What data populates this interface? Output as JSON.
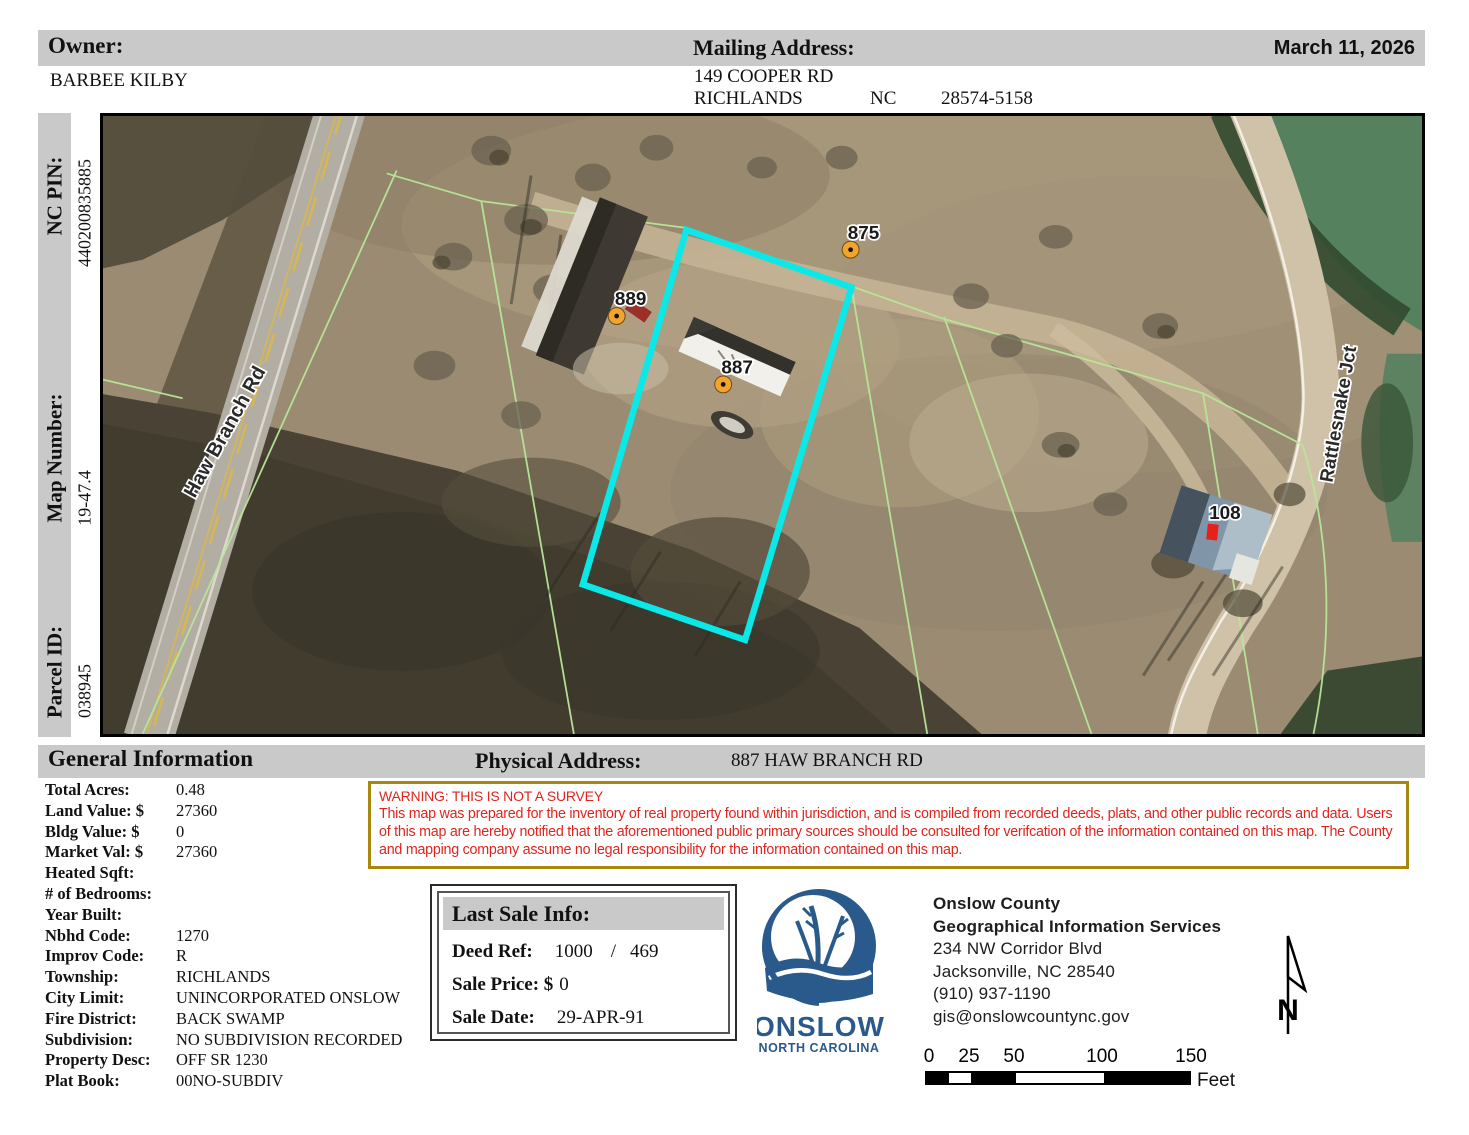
{
  "header": {
    "owner_label": "Owner:",
    "owner_value": "BARBEE KILBY",
    "mailing_label": "Mailing Address:",
    "mailing_line1": "149 COOPER RD",
    "mailing_city": "RICHLANDS",
    "mailing_state": "NC",
    "mailing_zip": "28574-5158",
    "date": "March 11, 2026"
  },
  "sidebar": {
    "nc_pin_label": "NC PIN:",
    "nc_pin_value": "440200835885",
    "map_number_label": "Map Number:",
    "map_number_value": "19-47.4",
    "parcel_id_label": "Parcel ID:",
    "parcel_id_value": "038945"
  },
  "map": {
    "road_label_left": "Haw Branch Rd",
    "road_label_right": "Rattlesnake Jct",
    "address_points": [
      {
        "id": "875"
      },
      {
        "id": "889"
      },
      {
        "id": "887"
      },
      {
        "id": "108"
      }
    ],
    "selected_parcel_color": "#0ae8e8",
    "address_marker_color": "#f2a52e",
    "house_marker_color": "#e8201c",
    "parcel_line_color": "#b8e698"
  },
  "general_info": {
    "section_title": "General Information",
    "physical_address_label": "Physical Address:",
    "physical_address_value": "887 HAW BRANCH RD",
    "fields": [
      {
        "label": "Total Acres:",
        "value": "0.48"
      },
      {
        "label": "Land Value: $",
        "value": "27360"
      },
      {
        "label": "Bldg Value: $",
        "value": "0"
      },
      {
        "label": "Market Val: $",
        "value": "27360"
      },
      {
        "label": "Heated Sqft:",
        "value": ""
      },
      {
        "label": "# of Bedrooms:",
        "value": ""
      },
      {
        "label": "Year Built:",
        "value": ""
      },
      {
        "label": "Nbhd Code:",
        "value": "1270"
      },
      {
        "label": "Improv Code:",
        "value": "R"
      },
      {
        "label": "Township:",
        "value": "RICHLANDS"
      },
      {
        "label": "City Limit:",
        "value": "UNINCORPORATED ONSLOW"
      },
      {
        "label": "Fire District:",
        "value": "BACK SWAMP"
      },
      {
        "label": "Subdivision:",
        "value": "NO SUBDIVISION RECORDED"
      },
      {
        "label": "Property Desc:",
        "value": "OFF SR 1230"
      },
      {
        "label": "Plat Book:",
        "value": "00NO-SUBDIV"
      }
    ]
  },
  "warning": {
    "title": "WARNING: THIS IS NOT A SURVEY",
    "body": "This map was prepared for the inventory of real property found within jurisdiction, and is compiled from recorded deeds, plats, and other public records and data. Users of this map are hereby notified that the aforementioned public primary sources should be consulted for verifcation of the information contained on this map. The County and mapping company assume no legal responsibility for the information contained on this map."
  },
  "last_sale": {
    "title": "Last Sale Info:",
    "deed_ref_label": "Deed Ref:",
    "deed_ref_book": "1000",
    "deed_ref_sep": "/",
    "deed_ref_page": "469",
    "sale_price_label": "Sale Price: $",
    "sale_price_value": "0",
    "sale_date_label": "Sale Date:",
    "sale_date_value": "29-APR-91"
  },
  "agency": {
    "logo_text": "ONSLOW",
    "logo_subtext": "NORTH CAROLINA",
    "logo_color": "#2a5a8c",
    "name": "Onslow County",
    "dept": "Geographical Information Services",
    "street": "234 NW Corridor Blvd",
    "city": "Jacksonville, NC 28540",
    "phone": "(910) 937-1190",
    "email": "gis@onslowcountync.gov"
  },
  "scale_bar": {
    "ticks": [
      "0",
      "25",
      "50",
      "100",
      "150"
    ],
    "unit": "Feet"
  },
  "north_arrow": {
    "letter": "N"
  }
}
